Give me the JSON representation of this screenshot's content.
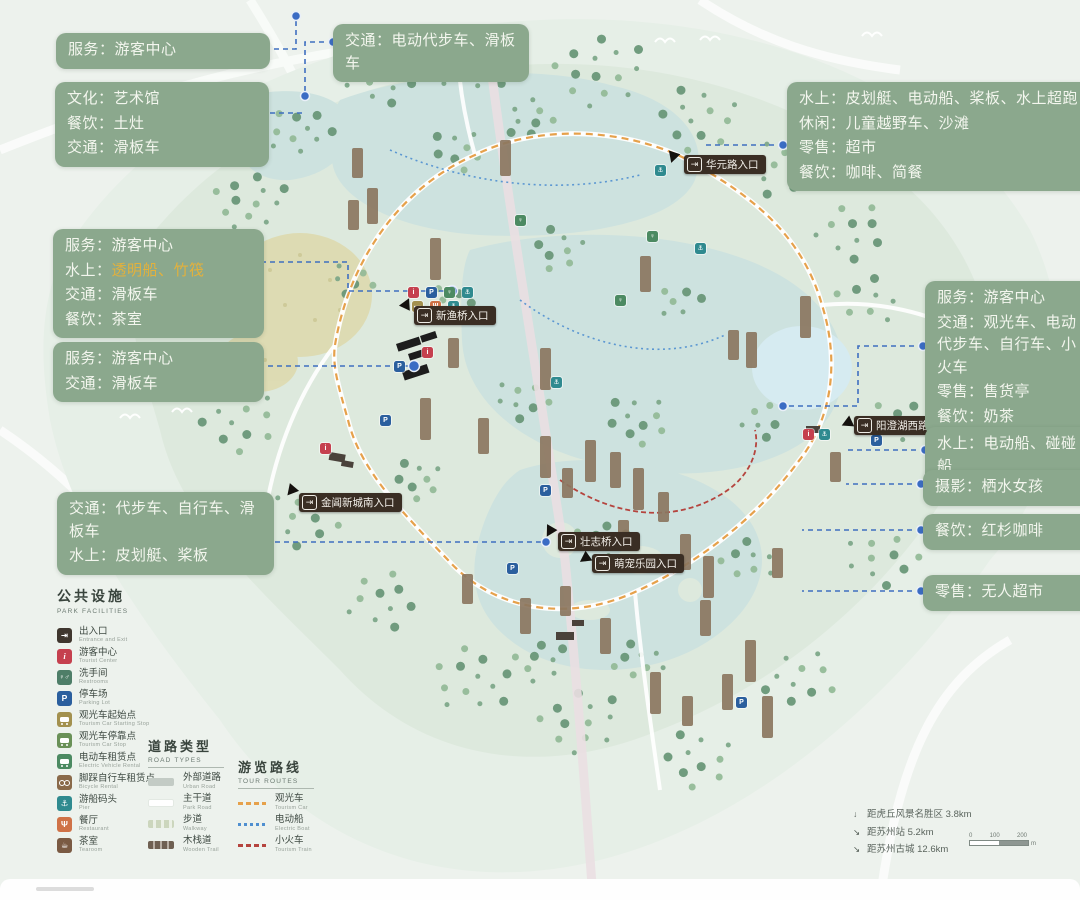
{
  "colors": {
    "callout_bg": "#8ba88d",
    "highlight_gold": "#e3b13c",
    "connector_blue": "#3f6fc0",
    "entrance_bg": "#3a2e24",
    "water": "#cde2df",
    "land": "#dde9dd"
  },
  "callouts": [
    {
      "lines": [
        {
          "label": "服务：",
          "value": "游客中心"
        }
      ]
    },
    {
      "lines": [
        {
          "label": "交通：",
          "value": "电动代步车、滑板车"
        }
      ]
    },
    {
      "lines": [
        {
          "label": "文化：",
          "value": "艺术馆"
        },
        {
          "label": "餐饮：",
          "value": "土灶"
        },
        {
          "label": "交通：",
          "value": "滑板车"
        }
      ]
    },
    {
      "lines": [
        {
          "label": "水上：",
          "value": "皮划艇、电动船、桨板、水上超跑"
        },
        {
          "label": "休闲：",
          "value": "儿童越野车、沙滩"
        },
        {
          "label": "零售：",
          "value": "超市"
        },
        {
          "label": "餐饮：",
          "value": "咖啡、简餐"
        }
      ]
    },
    {
      "lines": [
        {
          "label": "服务：",
          "value": "游客中心"
        },
        {
          "label": "水上：",
          "value": "透明船、竹筏",
          "tone": "gold"
        },
        {
          "label": "交通：",
          "value": "滑板车"
        },
        {
          "label": "餐饮：",
          "value": "茶室"
        }
      ]
    },
    {
      "lines": [
        {
          "label": "服务：",
          "value": "游客中心"
        },
        {
          "label": "交通：",
          "value": "滑板车"
        }
      ]
    },
    {
      "lines": [
        {
          "label": "交通：",
          "value": "代步车、自行车、滑板车"
        },
        {
          "label": "水上：",
          "value": "皮划艇、桨板"
        }
      ]
    },
    {
      "lines": [
        {
          "label": "服务：",
          "value": "游客中心"
        },
        {
          "label": "交通：",
          "value": "观光车、电动代步车、自行车、小火车"
        },
        {
          "label": "零售：",
          "value": "售货亭"
        },
        {
          "label": "餐饮：",
          "value": "奶茶"
        }
      ]
    },
    {
      "lines": [
        {
          "label": "水上：",
          "value": "电动船、碰碰船"
        }
      ]
    },
    {
      "lines": [
        {
          "label": "摄影：",
          "value": "栖水女孩"
        }
      ]
    },
    {
      "lines": [
        {
          "label": "餐饮：",
          "value": "红杉咖啡"
        }
      ]
    },
    {
      "lines": [
        {
          "label": "零售：",
          "value": "无人超市"
        }
      ]
    }
  ],
  "entrances": [
    {
      "name": "华元路入口"
    },
    {
      "name": "新渔桥入口"
    },
    {
      "name": "阳澄湖西路入口"
    },
    {
      "name": "金阊新城南入口"
    },
    {
      "name": "壮志桥入口"
    },
    {
      "name": "萌宠乐园入口"
    }
  ],
  "map": {
    "entrance_icon_glyph": "⇥",
    "marker_types": {
      "i": {
        "glyph": "i",
        "color": "#c5404e",
        "name": "tourist-center"
      },
      "p": {
        "glyph": "P",
        "color": "#2b5f9e",
        "name": "parking"
      },
      "g": {
        "glyph": "♀",
        "color": "#4c8a62",
        "name": "restroom"
      },
      "t": {
        "glyph": "⚓",
        "color": "#2f8a8f",
        "name": "pier"
      },
      "o": {
        "glyph": "Ψ",
        "color": "#cf7247",
        "name": "restaurant"
      },
      "y": {
        "glyph": "▬",
        "color": "#a3914f",
        "name": "tour-car-stop"
      }
    },
    "markers": [
      {
        "t": "i",
        "x": 413,
        "y": 292
      },
      {
        "t": "p",
        "x": 431,
        "y": 292
      },
      {
        "t": "g",
        "x": 449,
        "y": 292
      },
      {
        "t": "t",
        "x": 467,
        "y": 292
      },
      {
        "t": "y",
        "x": 417,
        "y": 306
      },
      {
        "t": "o",
        "x": 435,
        "y": 306
      },
      {
        "t": "t",
        "x": 453,
        "y": 306
      },
      {
        "t": "i",
        "x": 427,
        "y": 352
      },
      {
        "t": "p",
        "x": 399,
        "y": 366
      },
      {
        "t": "i",
        "x": 325,
        "y": 448
      },
      {
        "t": "p",
        "x": 385,
        "y": 420
      },
      {
        "t": "p",
        "x": 545,
        "y": 490
      },
      {
        "t": "p",
        "x": 512,
        "y": 568
      },
      {
        "t": "i",
        "x": 808,
        "y": 434
      },
      {
        "t": "t",
        "x": 824,
        "y": 434
      },
      {
        "t": "p",
        "x": 876,
        "y": 440
      },
      {
        "t": "p",
        "x": 741,
        "y": 702
      },
      {
        "t": "g",
        "x": 652,
        "y": 236
      },
      {
        "t": "t",
        "x": 700,
        "y": 248
      },
      {
        "t": "t",
        "x": 556,
        "y": 382
      },
      {
        "t": "g",
        "x": 620,
        "y": 300
      },
      {
        "t": "t",
        "x": 660,
        "y": 170
      },
      {
        "t": "g",
        "x": 520,
        "y": 220
      }
    ]
  },
  "legend": {
    "facilities": {
      "title": "公共设施",
      "subtitle": "PARK FACILITIES",
      "items": [
        {
          "zh": "出入口",
          "en": "Entrance and Exit",
          "glyph": "⇥",
          "color": "#3f362e",
          "icon": "entrance-icon"
        },
        {
          "zh": "游客中心",
          "en": "Tourist Center",
          "glyph": "i",
          "color": "#c5404e",
          "icon": "info-icon"
        },
        {
          "zh": "洗手间",
          "en": "Restrooms",
          "glyph": "♀♂",
          "color": "#4e7e68",
          "icon": "restroom-icon"
        },
        {
          "zh": "停车场",
          "en": "Parking Lot",
          "glyph": "P",
          "color": "#2b5f9e",
          "icon": "parking-icon"
        },
        {
          "zh": "观光车起始点",
          "en": "Tourism Car Starting Stop",
          "glyph": "",
          "color": "#a3914f",
          "icon": "bus-icon"
        },
        {
          "zh": "观光车停靠点",
          "en": "Tourism Car Stop",
          "glyph": "",
          "color": "#6a9158",
          "icon": "bus-icon"
        },
        {
          "zh": "电动车租赁点",
          "en": "Electric Vehicle Rental",
          "glyph": "",
          "color": "#4c8a62",
          "icon": "bus-icon"
        },
        {
          "zh": "脚踩自行车租赁点",
          "en": "Bicycle Rental",
          "glyph": "",
          "color": "#8a6a4a",
          "icon": "bicycle-icon"
        },
        {
          "zh": "游船码头",
          "en": "Pier",
          "glyph": "⚓",
          "color": "#2f8a8f",
          "icon": "boat-icon"
        },
        {
          "zh": "餐厅",
          "en": "Restaurant",
          "glyph": "Ψ",
          "color": "#cf7247",
          "icon": "restaurant-icon"
        },
        {
          "zh": "茶室",
          "en": "Tearoom",
          "glyph": "☕",
          "color": "#7a5a43",
          "icon": "tea-icon"
        }
      ]
    },
    "road_types": {
      "title": "道路类型",
      "subtitle": "ROAD TYPES",
      "items": [
        {
          "zh": "外部道路",
          "en": "Urban Road"
        },
        {
          "zh": "主干道",
          "en": "Park Road"
        },
        {
          "zh": "步道",
          "en": "Walkway"
        },
        {
          "zh": "木栈道",
          "en": "Wooden Trail"
        }
      ]
    },
    "tour_routes": {
      "title": "游览路线",
      "subtitle": "TOUR ROUTES",
      "items": [
        {
          "zh": "观光车",
          "en": "Tourism Car"
        },
        {
          "zh": "电动船",
          "en": "Electric Boat"
        },
        {
          "zh": "小火车",
          "en": "Tourism Train"
        }
      ]
    }
  },
  "info": {
    "distances": [
      {
        "icon": "↓",
        "text": "距虎丘风景名胜区 3.8km"
      },
      {
        "icon": "↘",
        "text": "距苏州站 5.2km"
      },
      {
        "icon": "↘",
        "text": "距苏州古城 12.6km"
      }
    ],
    "scale": {
      "start": "0",
      "mid": "100",
      "end": "200",
      "unit": "m"
    }
  }
}
